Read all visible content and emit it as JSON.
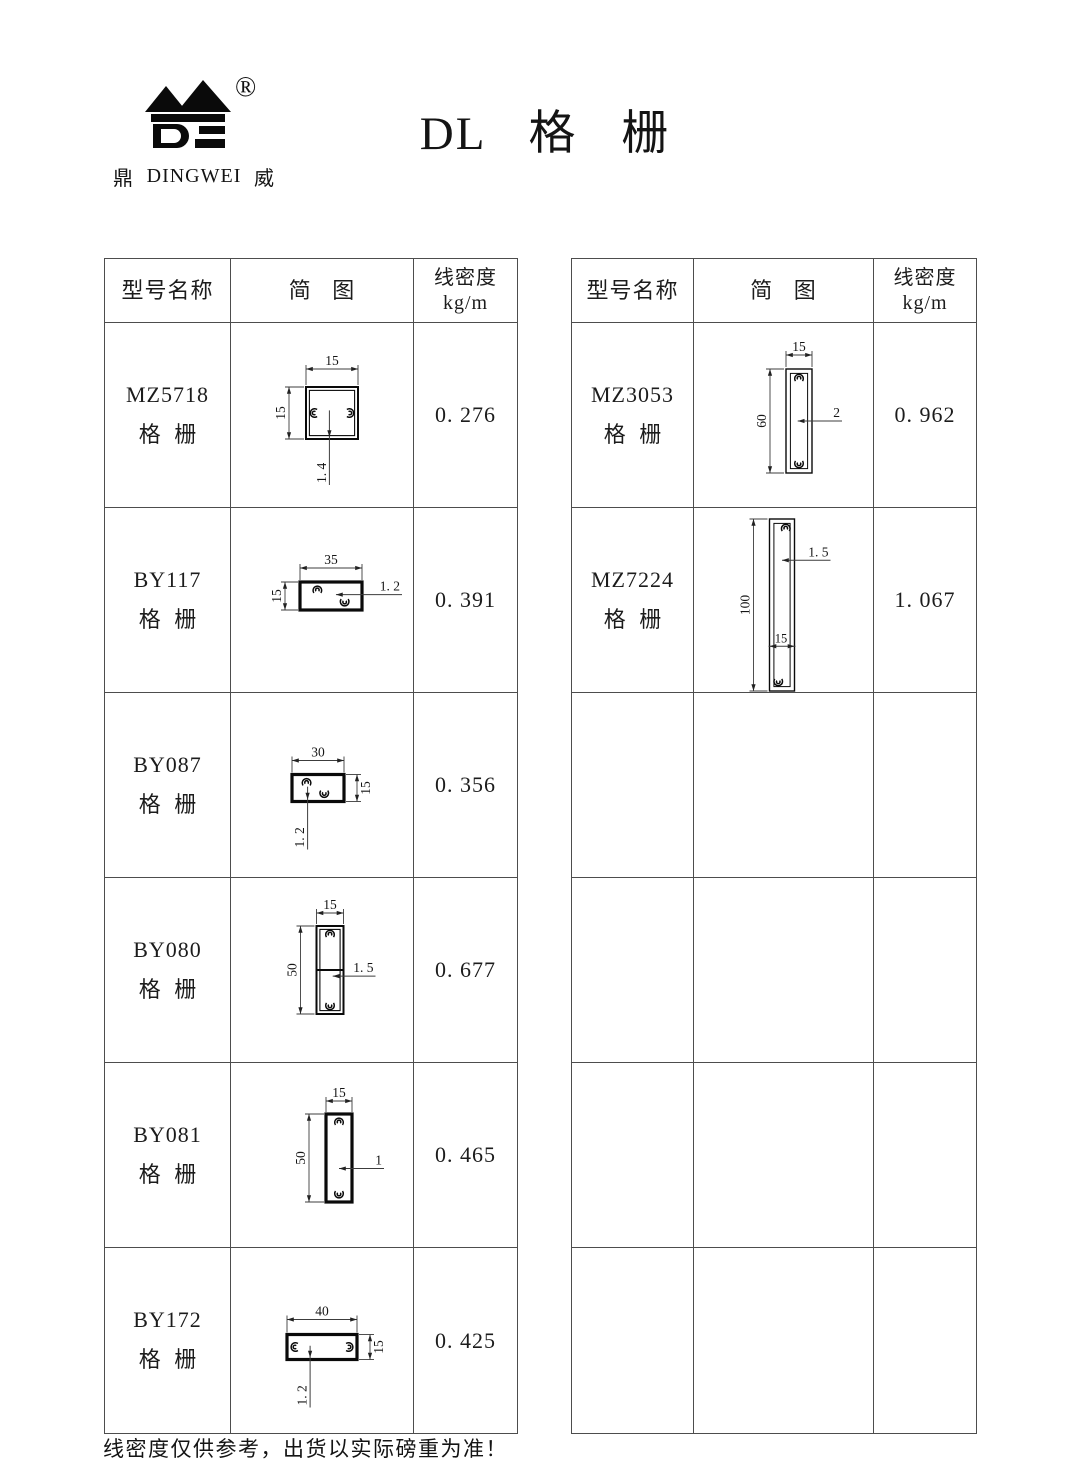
{
  "page": {
    "title": "DL 格 栅",
    "footer": "线密度仅供参考，出货以实际磅重为准！"
  },
  "logo": {
    "cn_left": "鼎",
    "en": "DINGWEI",
    "cn_right": "威",
    "reg": "®"
  },
  "headers": {
    "model": "型号名称",
    "diagram": "简 图",
    "density_l1": "线密度",
    "density_l2": "kg/m"
  },
  "left_table": {
    "rows": [
      {
        "model_code": "MZ5718",
        "model_type": "格 栅",
        "density": "0. 276",
        "diagram": {
          "box": [
            52,
            52
          ],
          "center": [
            101,
            90
          ],
          "style": "double",
          "bosses": [
            {
              "side": "left",
              "pos": 0.5
            },
            {
              "side": "right",
              "pos": 0.5
            }
          ],
          "dims": [
            {
              "kind": "top",
              "label": "15",
              "off": 18
            },
            {
              "kind": "left",
              "label": "15",
              "off": 17
            },
            {
              "kind": "ldown",
              "label": "1. 4",
              "fx": 0.45,
              "len": 46
            }
          ]
        }
      },
      {
        "model_code": "BY117",
        "model_type": "格 栅",
        "density": "0. 391",
        "diagram": {
          "box": [
            62,
            28
          ],
          "center": [
            100,
            88
          ],
          "style": "thick",
          "bosses": [
            {
              "side": "top",
              "pos": 0.28
            },
            {
              "side": "bottom",
              "pos": 0.72
            }
          ],
          "dims": [
            {
              "kind": "top",
              "label": "35",
              "off": 14
            },
            {
              "kind": "left",
              "label": "15",
              "off": 15
            },
            {
              "kind": "lright",
              "label": "1. 2",
              "fx": 0.58,
              "fy": 0.45,
              "len": 40
            }
          ]
        }
      },
      {
        "model_code": "BY087",
        "model_type": "格 栅",
        "density": "0. 356",
        "diagram": {
          "box": [
            52,
            27
          ],
          "center": [
            87,
            95
          ],
          "style": "thick",
          "bosses": [
            {
              "side": "top",
              "pos": 0.28
            },
            {
              "side": "bottom",
              "pos": 0.62
            }
          ],
          "dims": [
            {
              "kind": "top",
              "label": "30",
              "off": 14
            },
            {
              "kind": "right",
              "label": "15",
              "off": 13
            },
            {
              "kind": "ldown",
              "label": "1. 2",
              "fx": 0.3,
              "len": 48
            }
          ]
        }
      },
      {
        "model_code": "BY080",
        "model_type": "格 栅",
        "density": "0. 677",
        "diagram": {
          "box": [
            27,
            88
          ],
          "center": [
            99,
            92
          ],
          "style": "double",
          "divider": true,
          "bosses": [
            {
              "side": "top",
              "pos": 0.5
            },
            {
              "side": "bottom",
              "pos": 0.5
            }
          ],
          "dims": [
            {
              "kind": "top",
              "label": "15",
              "off": 13
            },
            {
              "kind": "left",
              "label": "50",
              "off": 16
            },
            {
              "kind": "lright",
              "label": "1. 5",
              "fx": 0.6,
              "fy": 0.57,
              "len": 32
            }
          ]
        }
      },
      {
        "model_code": "BY081",
        "model_type": "格 栅",
        "density": "0. 465",
        "diagram": {
          "box": [
            26,
            88
          ],
          "center": [
            108,
            95
          ],
          "style": "thick",
          "bosses": [
            {
              "side": "top",
              "pos": 0.5
            },
            {
              "side": "bottom",
              "pos": 0.5
            }
          ],
          "dims": [
            {
              "kind": "top",
              "label": "15",
              "off": 13
            },
            {
              "kind": "left",
              "label": "50",
              "off": 17
            },
            {
              "kind": "lright",
              "label": "1",
              "fx": 0.5,
              "fy": 0.62,
              "len": 32
            }
          ]
        }
      },
      {
        "model_code": "BY172",
        "model_type": "格 栅",
        "density": "0. 425",
        "diagram": {
          "box": [
            70,
            25
          ],
          "center": [
            91,
            99
          ],
          "style": "thick",
          "bosses": [
            {
              "side": "left",
              "pos": 0.5
            },
            {
              "side": "right",
              "pos": 0.5
            }
          ],
          "dims": [
            {
              "kind": "top",
              "label": "40",
              "off": 15
            },
            {
              "kind": "right",
              "label": "15",
              "off": 13
            },
            {
              "kind": "ldown",
              "label": "1. 2",
              "fx": 0.33,
              "len": 48
            }
          ]
        }
      }
    ]
  },
  "right_table": {
    "rows": [
      {
        "model_code": "MZ3053",
        "model_type": "格 栅",
        "density": "0. 962",
        "diagram": {
          "box": [
            26,
            104
          ],
          "center": [
            105,
            98
          ],
          "style": "thin",
          "bosses": [
            {
              "side": "top",
              "pos": 0.5
            },
            {
              "side": "bottom",
              "pos": 0.5
            }
          ],
          "dims": [
            {
              "kind": "top",
              "label": "15",
              "off": 14
            },
            {
              "kind": "left",
              "label": "60",
              "off": 16
            },
            {
              "kind": "lright",
              "label": "2",
              "fx": 0.45,
              "fy": 0.5,
              "len": 30
            }
          ]
        }
      },
      {
        "model_code": "MZ7224",
        "model_type": "格 栅",
        "density": "1. 067",
        "diagram": {
          "box": [
            25,
            172
          ],
          "center": [
            88,
            97
          ],
          "style": "thin",
          "bosses": [
            {
              "side": "top",
              "pos": 0.65
            },
            {
              "side": "bottom",
              "pos": 0.35
            }
          ],
          "dims": [
            {
              "kind": "left",
              "label": "100",
              "off": 16
            },
            {
              "kind": "lright",
              "label": "1. 5",
              "fx": 0.5,
              "fy": 0.24,
              "len": 36
            },
            {
              "kind": "innerh",
              "label": "15",
              "fy": 0.74
            }
          ]
        }
      },
      {
        "model_code": "",
        "model_type": "",
        "density": "",
        "diagram": null
      },
      {
        "model_code": "",
        "model_type": "",
        "density": "",
        "diagram": null
      },
      {
        "model_code": "",
        "model_type": "",
        "density": "",
        "diagram": null
      },
      {
        "model_code": "",
        "model_type": "",
        "density": "",
        "diagram": null
      }
    ]
  }
}
